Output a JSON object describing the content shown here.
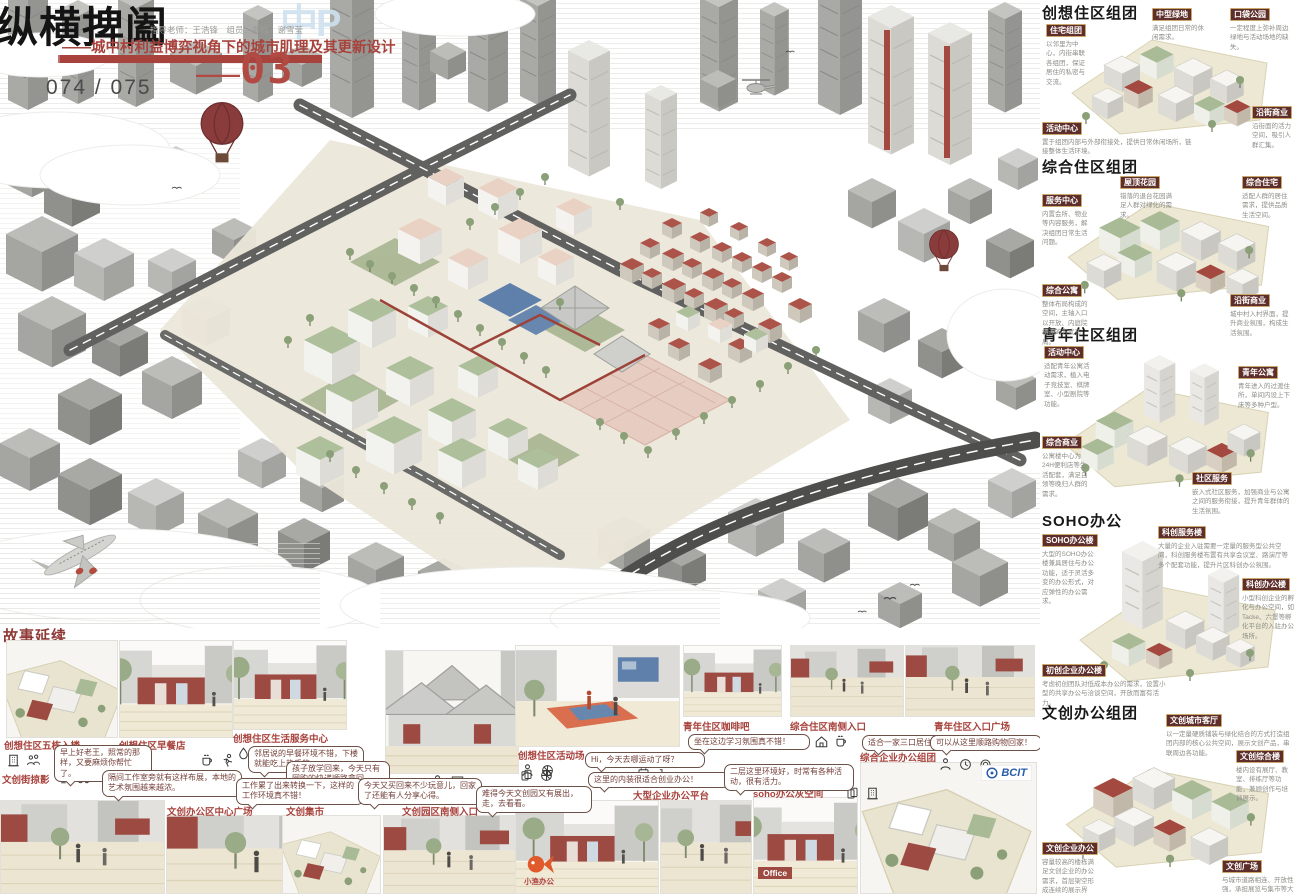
{
  "header": {
    "title": "纵横捭阖",
    "credits": "指导老师：王浩锋　组员：郑峰　谢雪莹",
    "subtitle": "——城中村利益博弈视角下的城市肌理及其更新设计",
    "panel_dash": "——",
    "panel_number": "03",
    "watermark": "中P",
    "page_number": "074 / 075"
  },
  "colors": {
    "accent_red": "#a8423c",
    "label_maroon": "#5d2e2b",
    "ground_beige": "#ece8d3",
    "roof_green": "#a9ba96",
    "village_red": "#a4493f",
    "watermark_blue": "#cfe0ef"
  },
  "main_scene": {
    "elements": [
      "hot-air-balloon-icon",
      "hot-air-balloon-icon",
      "helicopter-icon",
      "airplane-icon",
      "birds-icon",
      "clouds-icon"
    ]
  },
  "sidebar": {
    "sections": [
      {
        "title": "创想住区组团",
        "labels": [
          {
            "name": "住宅组团",
            "desc": "以邻里为中心，内街串联各组团，保证居住的私密与交流。"
          },
          {
            "name": "中型绿地",
            "desc": "满足组团日常的休闲需求。"
          },
          {
            "name": "口袋公园",
            "desc": "一定程度上弥补周边绿地与活动场地的缺失。"
          },
          {
            "name": "活动中心",
            "desc": "置于组团内部与外部衔接处，提供日常休闲场所，链接整体生活环境。"
          },
          {
            "name": "沿街商业",
            "desc": "沿街面的活力空间，吸引人群汇集。"
          }
        ]
      },
      {
        "title": "综合住区组团",
        "labels": [
          {
            "name": "服务中心",
            "desc": "内置会所、物业等内容服务，解决组团日常生活问题。"
          },
          {
            "name": "屋顶花园",
            "desc": "错落的退台花园满足人群对绿化的需求。"
          },
          {
            "name": "综合住宅",
            "desc": "适配人群的居住需求，提供品质生活空间。"
          },
          {
            "name": "综合公寓",
            "desc": "整体布局构成的空间，主轴入口以开放、内庭院相连的方式布局。"
          },
          {
            "name": "沿街商业",
            "desc": "城中村入村界面，提升商业氛围，构成生活氛围。"
          }
        ]
      },
      {
        "title": "青年住区组团",
        "labels": [
          {
            "name": "活动中心",
            "desc": "适配青年公寓活动需求，植入电子竞技室、棋牌室、小型剧院等功能。"
          },
          {
            "name": "青年公寓",
            "desc": "青年进入的过渡住所，单间内设上下床等多种户型。"
          },
          {
            "name": "综合商业",
            "desc": "公寓楼中心为24H便利店等生活配套，满足白领等晚归人群的需求。"
          },
          {
            "name": "社区服务",
            "desc": "嵌入式社区服务，加强商业与公寓之间的服务衔接，提升青年群体的生活氛围。"
          }
        ]
      },
      {
        "title": "SOHO办公",
        "labels": [
          {
            "name": "SOHO办公楼",
            "desc": "大型的SOHO办公楼兼具居住与办公功能，适于灵活多变的办公形式，对应弹性的办公需求。"
          },
          {
            "name": "科创服务楼",
            "desc": "大量的企业入驻需要一定量的服务型公共空间，科创服务楼布置有共享会议室、路演厅等多个配套功能，提升片区科创办公氛围。"
          },
          {
            "name": "科创办公楼",
            "desc": "小型科创企业的孵化与办公空间，如 Tacke、六堡等孵化平台的入驻办公场所。"
          },
          {
            "name": "初创企业办公楼",
            "desc": "考虑初创团队对低成本办公的需求，设置小型的共享办公与洽谈空间，开放而富有活力。"
          }
        ]
      },
      {
        "title": "文创办公组团",
        "labels": [
          {
            "name": "文创城市客厅",
            "desc": "以一定量硬质铺装与绿化结合的方式打造组团内部的核心公共空间，展示文创产品，串联周边各功能。"
          },
          {
            "name": "文创综合楼",
            "desc": "楼内设有展厅、教室、排练厅等功能，兼顾创作与培训展示。"
          },
          {
            "name": "文创企业办公",
            "desc": "容量较高的楼栋满足文创企业的办公需求，首层架空形成连续的展示界面。"
          },
          {
            "name": "文创广场",
            "desc": "与城市道路相连、开放性强，承担展览与集市等大型活动，是组团的门户空间。"
          }
        ]
      }
    ]
  },
  "story": {
    "title": "故事延续",
    "panels": [
      {
        "caption": "创想住区五栋入楼",
        "bubble": "早上好老王，照常的那样，又要麻烦你帮忙了。",
        "icons": [
          "building-icon",
          "people-icon"
        ]
      },
      {
        "caption": "创想住区早餐店",
        "bubble": "邻居说的早餐环境不错，下楼就能吃上热乎的。",
        "icons": [
          "coffee-cup-icon",
          "runner-icon"
        ]
      },
      {
        "caption": "创想住区生活服务中心",
        "bubble": "孩子放学回来，今天只有网购的快递顺路拿回。",
        "icons": [
          "droplet-icon",
          "cards-icon"
        ]
      },
      {
        "caption": "综合服务中心",
        "bubble": "",
        "icons": [
          "person-icon",
          "chat-icon"
        ]
      },
      {
        "caption": "创想住区活动场",
        "bubble": "Hi，今天去哪运动了呀？",
        "icons": [
          "person-icon",
          "basketball-icon"
        ]
      },
      {
        "caption": "青年住区咖啡吧",
        "bubble": "坐在这边学习氛围真不错！",
        "icons": []
      },
      {
        "caption": "综合住区南侧入口",
        "bubble": "适合一家三口居住！",
        "icons": [
          "people-icon",
          "home-icon",
          "coffee-cup-icon"
        ]
      },
      {
        "caption": "青年住区入口广场",
        "bubble": "可以从这里顺路购物回家！",
        "icons": [
          "person-icon",
          "clock-icon",
          "wreath-icon"
        ]
      },
      {
        "caption": "文创街掠影",
        "bubble": "隔间工作室旁就有这样布展，本地的艺术氛围越来越浓。",
        "icons": [
          "tv-icon",
          "tractor-icon"
        ]
      },
      {
        "caption": "文创办公区中心广场",
        "bubble": "工作累了出来转换一下，这样的工作环境真不错！",
        "icons": [
          "chair-icon",
          "person-icon"
        ]
      },
      {
        "caption": "文创集市",
        "bubble": "今天又买回来不少玩意儿，回家了还能有人分享心得。",
        "icons": [
          "basket-icon",
          "utensils-icon"
        ]
      },
      {
        "caption": "文创园区南侧入口",
        "bubble": "难得今天文创园又有展出，走，去看看。",
        "icons": []
      },
      {
        "caption": "初创企业办公",
        "bubble": "这里的内装很适合创业办公！",
        "icons": [
          "cards-icon",
          "basketball-icon"
        ],
        "logo": "小渔办公"
      },
      {
        "caption": "大型企业办公平台",
        "bubble": "二层这里环境好，时常有各种活动，很有活力。",
        "icons": [
          "calendar-icon",
          "factory-icon"
        ]
      },
      {
        "caption": "soho办公灰空间",
        "bubble": "在家楼下喝咖啡办公，幸福感大大提升！",
        "icons": [
          "cards-icon",
          "building-icon"
        ],
        "logo": "Office"
      },
      {
        "caption": "综合企业办公组团",
        "bubble": "",
        "icons": [],
        "logo": "BCIT"
      }
    ]
  }
}
